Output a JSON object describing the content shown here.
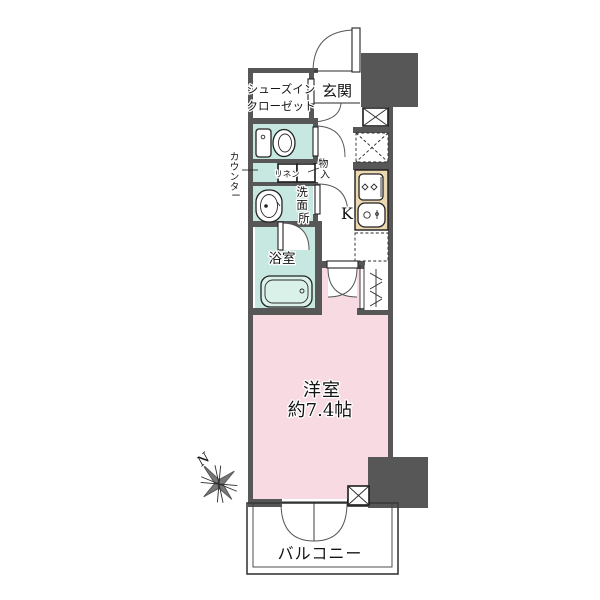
{
  "plan": {
    "labels": {
      "entrance": "玄関",
      "shoes_closet_line1": "シューズイン",
      "shoes_closet_line2": "クローゼット",
      "linen": "リネン",
      "bathroom": "浴室",
      "kitchen": "K",
      "room_name": "洋室",
      "room_size": "約7.4帖",
      "balcony": "バルコニー",
      "compass_north": "N"
    },
    "vertical_labels": {
      "counter": [
        "カ",
        "ウ",
        "ン",
        "タ",
        "ー"
      ],
      "storage": [
        "物",
        "入"
      ],
      "washroom": [
        "洗",
        "面",
        "所"
      ]
    },
    "colors": {
      "wall": "#575757",
      "teal": "#c7e8e0",
      "tealbox": "#c9ece5",
      "pink": "#f8dbe2",
      "beige": "#ecd9b2",
      "tub": "#daf1ea"
    }
  }
}
